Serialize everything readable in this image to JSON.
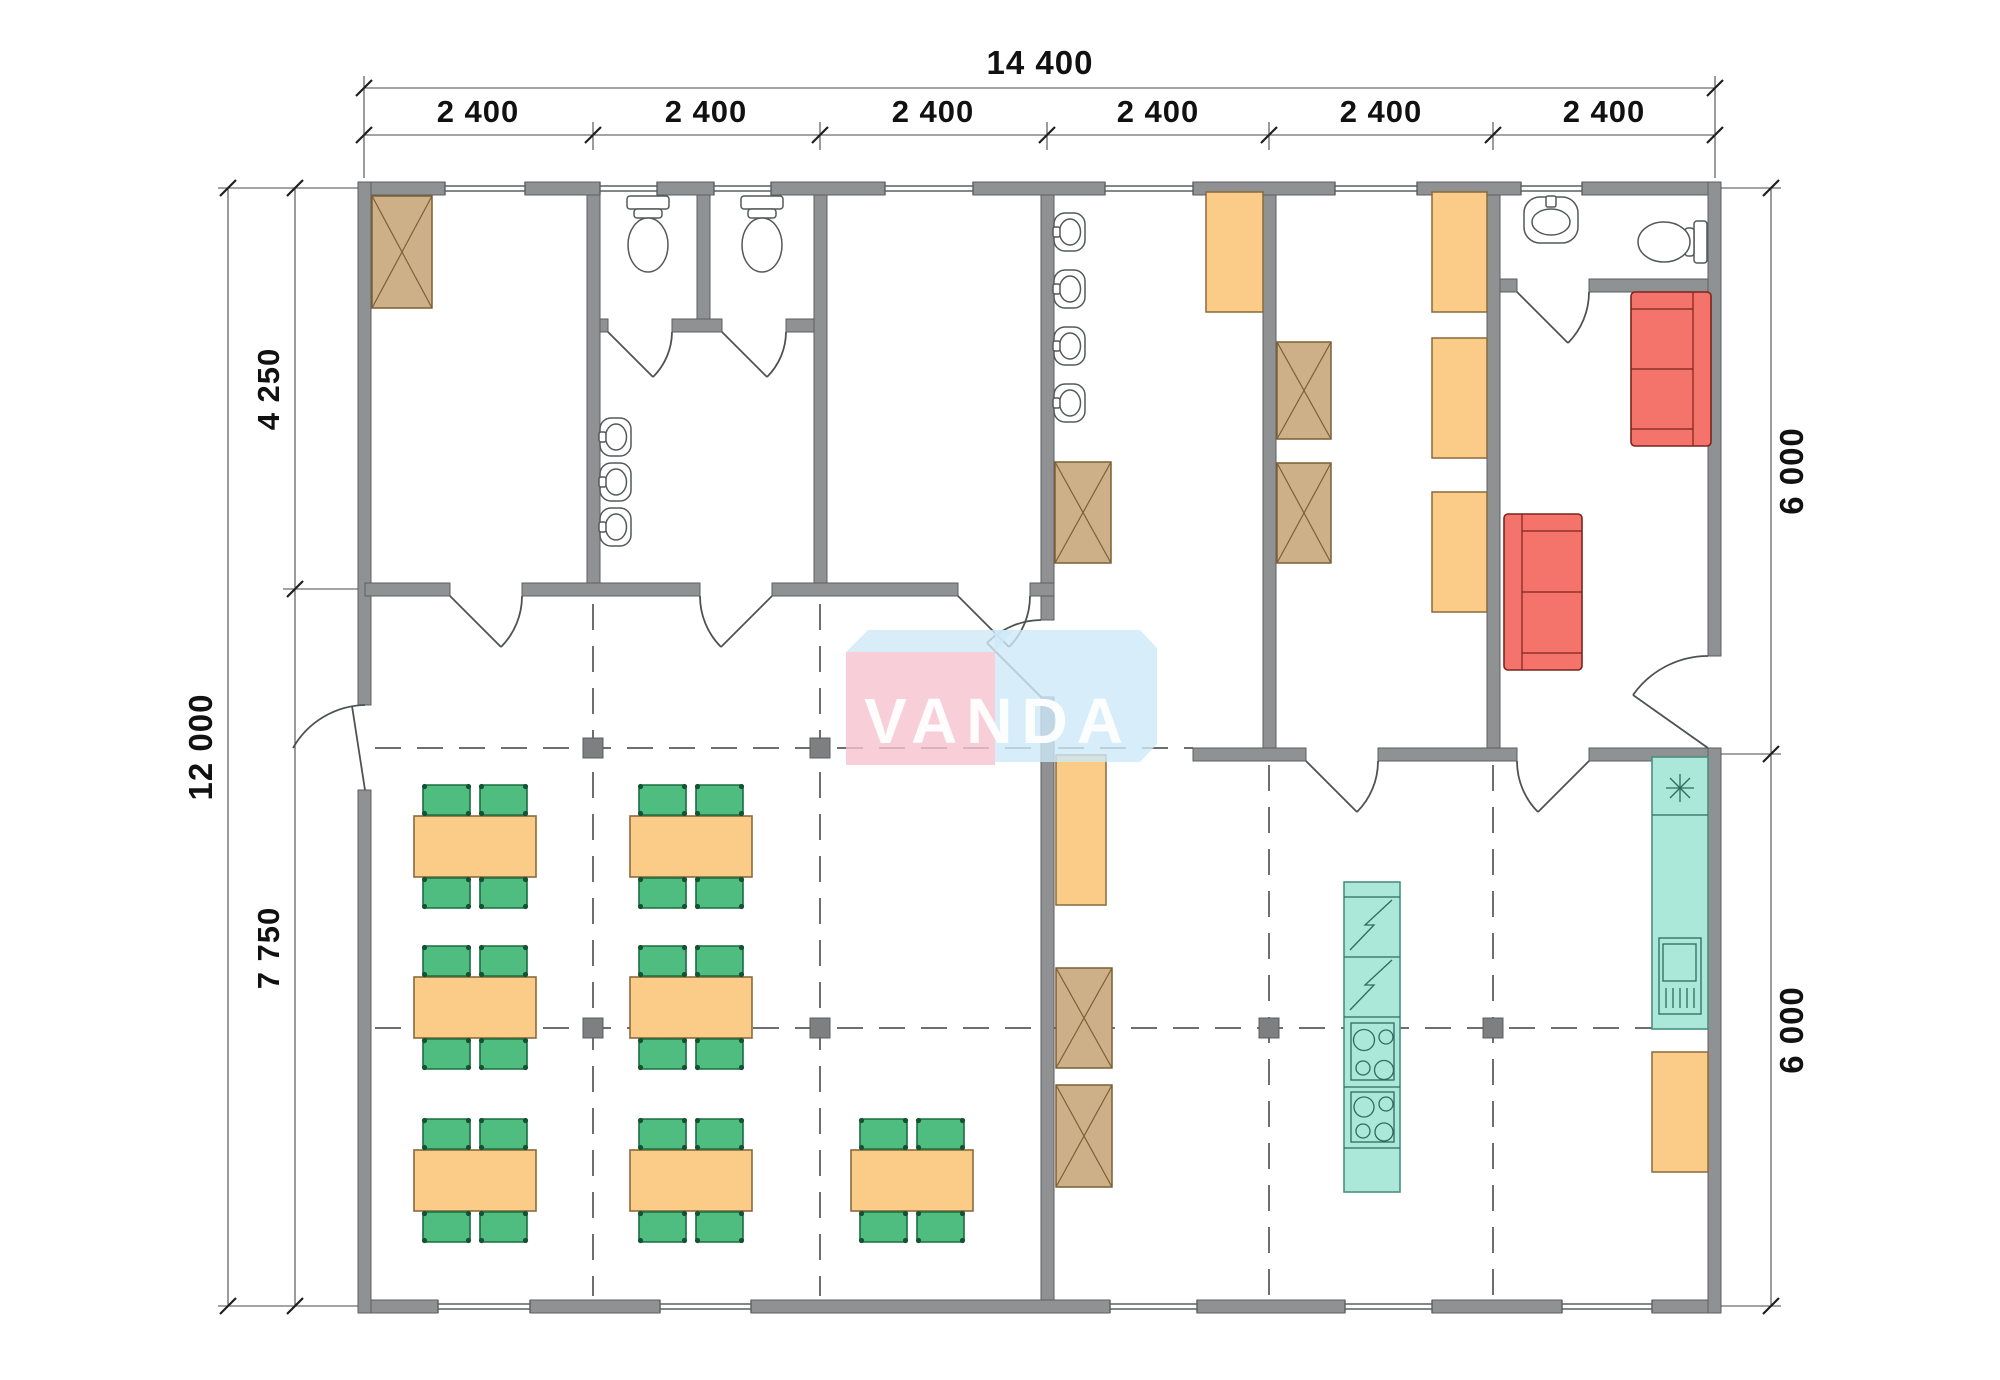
{
  "drawing": {
    "type": "architectural-floor-plan",
    "watermark_text": "VANDA"
  },
  "dimensions": {
    "top_total": "14 400",
    "top_modules": [
      "2 400",
      "2 400",
      "2 400",
      "2 400",
      "2 400",
      "2 400"
    ],
    "left_total": "12 000",
    "left_upper": "4 250",
    "left_lower": "7 750",
    "right_upper": "6 000",
    "right_lower": "6 000"
  },
  "colors": {
    "wall": "#8f9193",
    "cabinet_orange": "#fbcc87",
    "wardrobe_tan": "#cdb087",
    "chair_green": "#4fbd80",
    "sofa_red": "#f4736a",
    "kitchen_teal": "#abe8d9",
    "watermark_pink": "#f6c3ce",
    "watermark_blue": "#cde8f8"
  },
  "rooms": [
    {
      "name": "storage-room",
      "fixtures": {
        "wardrobes": 1
      }
    },
    {
      "name": "wc-stalls",
      "fixtures": {
        "toilets": 2,
        "washbasins": 3
      }
    },
    {
      "name": "empty-room",
      "fixtures": {}
    },
    {
      "name": "washroom",
      "fixtures": {
        "washbasins": 4,
        "wardrobes": 1,
        "cabinets": 1
      }
    },
    {
      "name": "locker-room",
      "fixtures": {
        "wardrobes": 2,
        "cabinets": 3
      }
    },
    {
      "name": "bathroom",
      "fixtures": {
        "toilets": 1,
        "washbasins": 1
      }
    },
    {
      "name": "lounge",
      "fixtures": {
        "sofas": 2
      }
    },
    {
      "name": "dining-hall",
      "fixtures": {
        "tables": 7,
        "chairs": 28
      }
    },
    {
      "name": "kitchen",
      "fixtures": {
        "fridges": 2,
        "stoves": 2,
        "sink_counter": 1,
        "freezer": 1,
        "cabinets": 3,
        "wardrobes": 2
      }
    }
  ]
}
